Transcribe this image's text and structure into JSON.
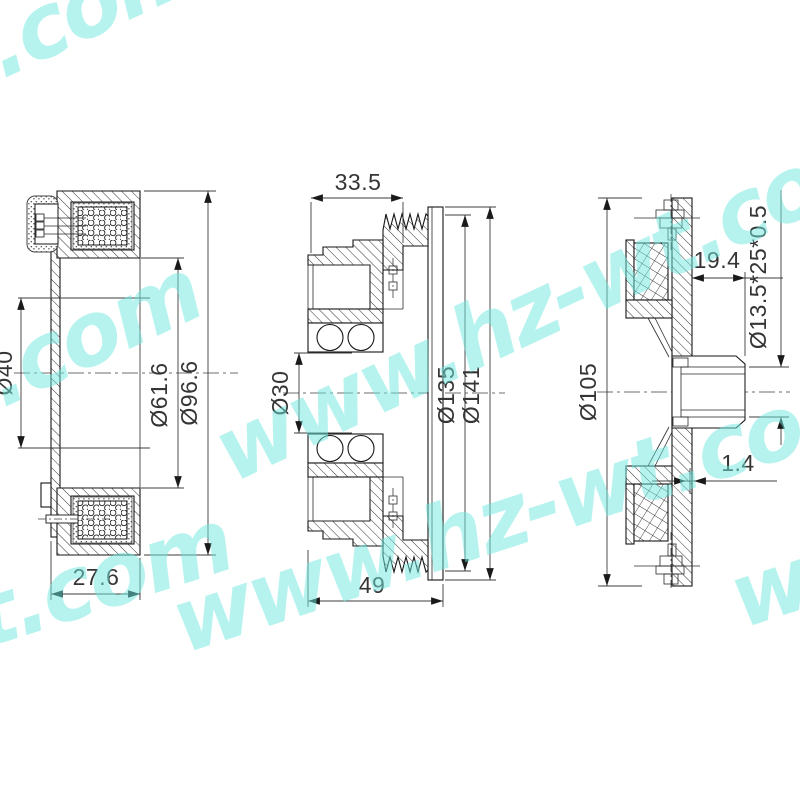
{
  "watermark": {
    "text": "www.hz-wt.com",
    "color": "#6fe9e0"
  },
  "dimensions": {
    "coil_view": {
      "bore": "Ø40",
      "inner_diameter": "Ø61.6",
      "outer_diameter": "Ø96.6",
      "width": "27.6"
    },
    "pulley_view": {
      "hub_width": "33.5",
      "bearing_bore": "Ø30",
      "groove_diameter": "Ø135",
      "outer_diameter": "Ø141",
      "total_width": "49"
    },
    "hub_view": {
      "hub_depth": "19.4",
      "spline_spec": "Ø13.5*25*0.5",
      "outer_diameter": "Ø105",
      "air_gap": "1.4"
    }
  }
}
